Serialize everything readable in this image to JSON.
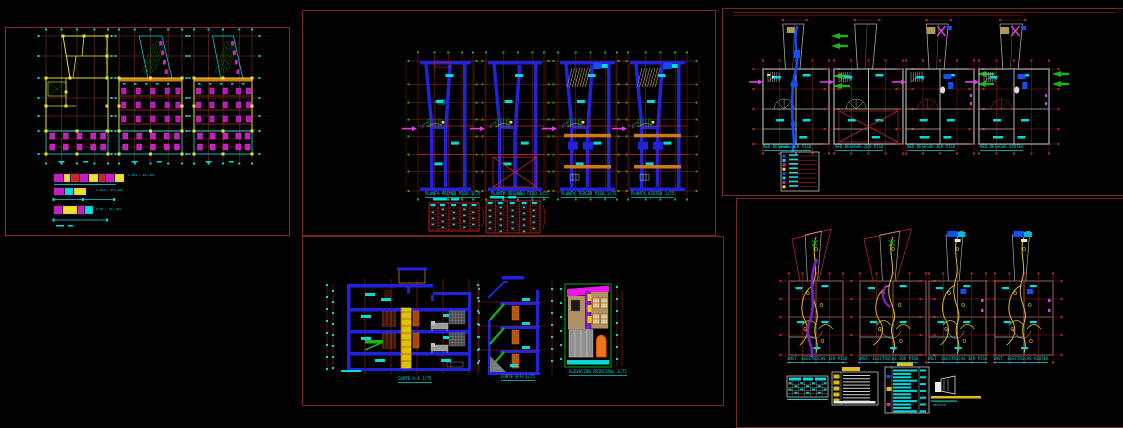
{
  "canvas": {
    "background": "#000000"
  },
  "palette": {
    "sheet_border": "#76291e",
    "grid_red": "#c22a22",
    "dim_cyan": "#00dcdc",
    "wall_blue": "#2222dd",
    "wall_gray": "#a8a8a8",
    "wall_yellow": "#e8e22a",
    "column_magenta": "#cc22cc",
    "wiring_yellow": "#e0c020",
    "arrow_green": "#16b416",
    "conduit_purple": "#8a1cc8",
    "beam_orange": "#d07818"
  },
  "structural": {
    "legend_items": [
      "V-101 (.25x.40)",
      "V-102 (.25x.40)",
      "V-CH (.15x.20)"
    ]
  },
  "architecture": {
    "plan_titles": [
      "PLANTA PRIMER PISO 1/75",
      "PLANTA SEGUNDO PISO 1/75",
      "PLANTA TERCER PISO 1/75",
      "PLANTA AZOTEA 1/75"
    ]
  },
  "sections": {
    "section_titles": [
      "CORTE A-A 1/75",
      "CORTE B-B 1/75"
    ],
    "elevation_title": "ELEVACION PRINCIPAL 1/75"
  },
  "sanitary": {
    "plan_titles": [
      "RED DESAGUE 1ER PISO",
      "RED DESAGUE 2DO PISO",
      "RED DESAGUE 3ER PISO",
      "RED DESAGUE AZOTEA"
    ],
    "legend_title": "LEYENDA"
  },
  "electrical": {
    "plan_titles": [
      "INST. ELECTRICAS 1ER PISO",
      "INST. ELECTRICAS 2DO PISO",
      "INST. ELECTRICAS 3ER PISO",
      "INST. ELECTRICAS AZOTEA"
    ],
    "detail_note": "DETALLE"
  }
}
